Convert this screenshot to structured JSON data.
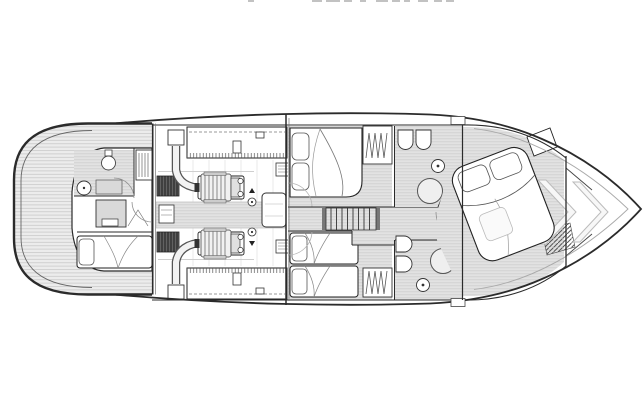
{
  "figure": {
    "kind": "floor-plan-diagram",
    "subject": "motor-yacht-lower-deck-arrangement",
    "cropped_text_fragment": {
      "visible": true,
      "legible": false
    },
    "colors": {
      "line": "#2b2b2b",
      "line_soft": "#8f8f8f",
      "faint": "#b5b5b5",
      "floor": "#e2e2e2",
      "floor_stripe": "#cdcdcd",
      "deck": "#ececec",
      "deck_stripe": "#c9c9c9",
      "dark_unit": "#3f3f3f",
      "dark_unit_stripe": "#6f6f6f",
      "shower_fill": "#efefef",
      "white": "#ffffff"
    },
    "areas": [
      "swim-platform",
      "aft-crew-cabin",
      "engine-room",
      "vip-cabin",
      "twin-cabin",
      "staircase-corridor",
      "head-starboard",
      "head-port",
      "master-cabin",
      "bow"
    ],
    "fixture_counts": {
      "engines": 2,
      "fuel_tanks": 2,
      "berths": 5,
      "sinks": 5,
      "toilets": 3,
      "showers": 3,
      "wardrobes": 3,
      "stair_treads": 9
    }
  }
}
